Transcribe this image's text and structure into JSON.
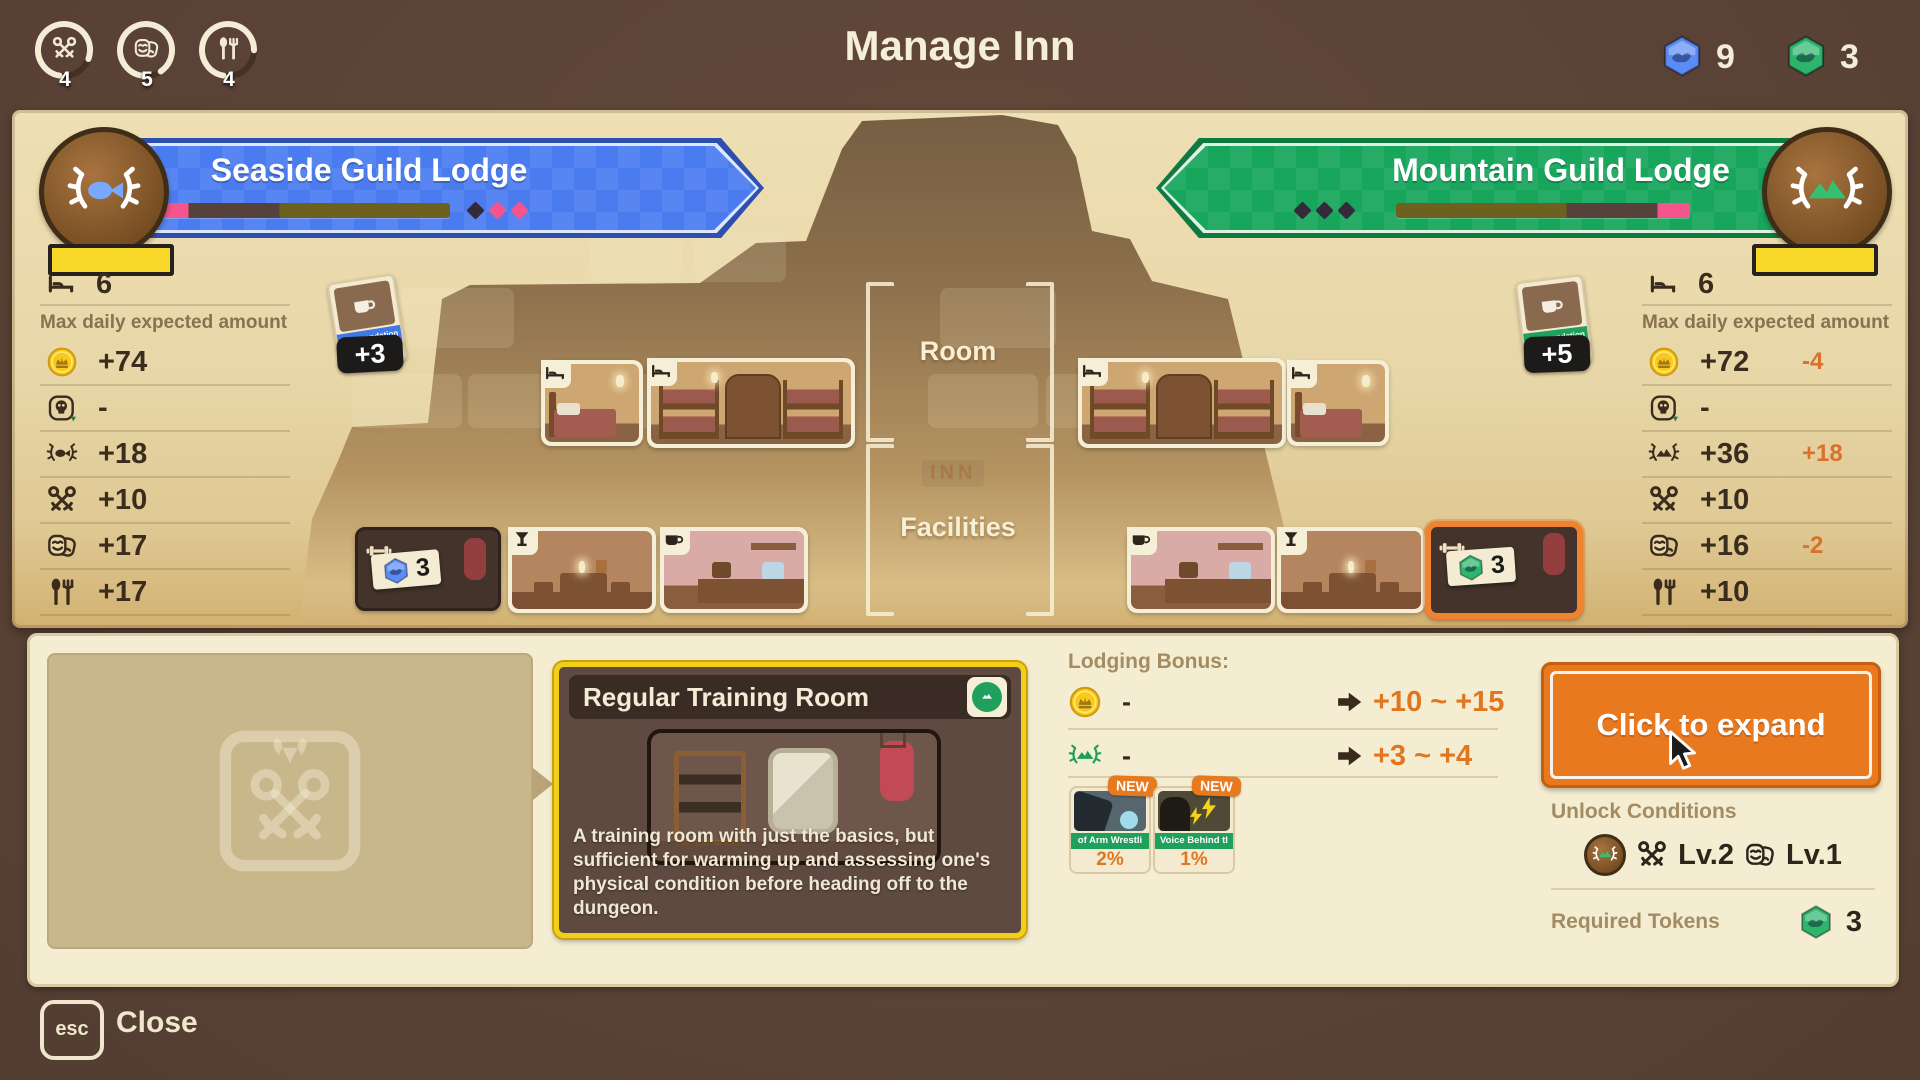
{
  "header": {
    "title": "Manage Inn",
    "meters": [
      {
        "icon": "keys-icon",
        "value": "4"
      },
      {
        "icon": "masks-icon",
        "value": "5"
      },
      {
        "icon": "utensils-icon",
        "value": "4"
      }
    ],
    "tokens": {
      "blue": "9",
      "green": "3"
    }
  },
  "lodges": {
    "left": {
      "name": "Seaside Guild Lodge",
      "beds": "6",
      "max_label": "Max daily expected amount",
      "stats": [
        {
          "icon": "coin",
          "value": "+74",
          "delta": ""
        },
        {
          "icon": "skull",
          "value": "-",
          "delta": ""
        },
        {
          "icon": "laurel-fish",
          "value": "+18",
          "delta": ""
        },
        {
          "icon": "keys",
          "value": "+10",
          "delta": ""
        },
        {
          "icon": "masks",
          "value": "+17",
          "delta": ""
        },
        {
          "icon": "utensils",
          "value": "+17",
          "delta": ""
        }
      ],
      "commendation": {
        "label": "Commendation",
        "percent": "5%",
        "bonus": "+3"
      }
    },
    "right": {
      "name": "Mountain Guild Lodge",
      "beds": "6",
      "max_label": "Max daily expected amount",
      "stats": [
        {
          "icon": "coin",
          "value": "+72",
          "delta": "-4"
        },
        {
          "icon": "skull",
          "value": "-",
          "delta": ""
        },
        {
          "icon": "laurel-mountain",
          "value": "+36",
          "delta": "+18"
        },
        {
          "icon": "keys",
          "value": "+10",
          "delta": ""
        },
        {
          "icon": "masks",
          "value": "+16",
          "delta": "-2"
        },
        {
          "icon": "utensils",
          "value": "+10",
          "delta": ""
        }
      ],
      "commendation": {
        "label": "Commendation",
        "percent": "3%",
        "bonus": "+5"
      }
    }
  },
  "map": {
    "room_label": "Room",
    "facilities_label": "Facilities",
    "inn_sign": "INN",
    "left_locked_count": "3",
    "right_selected_count": "3"
  },
  "detail": {
    "card": {
      "title": "Regular Training Room",
      "description": "A training room with just the basics, but sufficient for warming up and assessing one's physical condition before heading off to the dungeon."
    },
    "lodging_bonus": {
      "label": "Lodging Bonus:",
      "rows": [
        {
          "icon": "coin",
          "current": "-",
          "range": "+10 ~ +15"
        },
        {
          "icon": "laurel-mountain",
          "current": "-",
          "range": "+3 ~ +4"
        }
      ],
      "cards": [
        {
          "badge": "NEW",
          "label": "of Arm Wrestli",
          "percent": "2%"
        },
        {
          "badge": "NEW",
          "label": "Voice Behind tl",
          "percent": "1%"
        }
      ]
    },
    "expand_label": "Click to expand",
    "unlock": {
      "label": "Unlock Conditions",
      "key_level": "Lv.2",
      "mask_level": "Lv.1"
    },
    "required": {
      "label": "Required Tokens",
      "count": "3"
    }
  },
  "footer": {
    "key": "esc",
    "label": "Close"
  }
}
